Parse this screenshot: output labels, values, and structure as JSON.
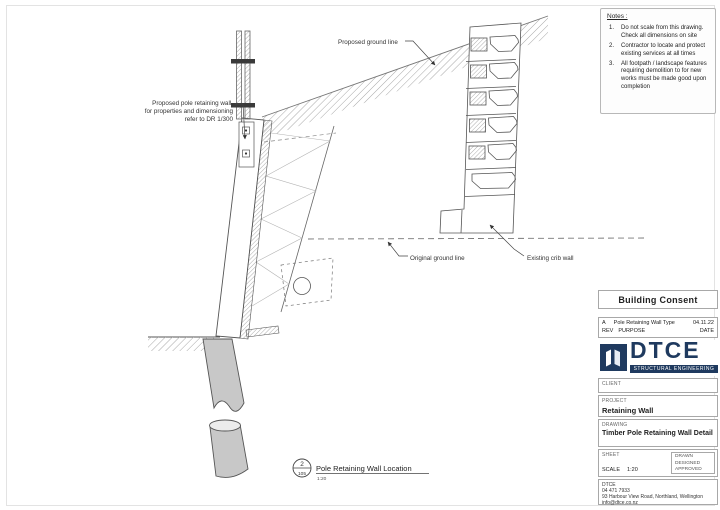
{
  "notes": {
    "title": "Notes :",
    "items": [
      {
        "num": "1.",
        "text": "Do not scale from this drawing. Check all dimensions on site"
      },
      {
        "num": "2.",
        "text": "Contractor to locate and protect existing services at all times"
      },
      {
        "num": "3.",
        "text": "All footpath / landscape features requiring demolition to for new works must be made good upon completion"
      }
    ]
  },
  "labels": {
    "proposed_ground_line": "Proposed ground line",
    "proposed_wall": {
      "line1": "Proposed pole retaining wall,",
      "line2": "for properties and dimensioning",
      "line3": "refer to DR 1/300"
    },
    "original_ground_line": "Original ground line",
    "existing_crib_wall": "Existing crib wall"
  },
  "callout": {
    "number": "2",
    "sheet": "105",
    "title": "Pole Retaining Wall Location",
    "scale": "1:20"
  },
  "title_block": {
    "consent": "Building Consent",
    "revision": {
      "rev": "A",
      "purpose": "Pole Retaining Wall Type",
      "date": "04.11.22",
      "rev_label": "REV",
      "purpose_label": "PURPOSE",
      "date_label": "DATE"
    },
    "logo": {
      "name": "DTCE",
      "tagline": "STRUCTURAL ENGINEERING"
    },
    "client_label": "CLIENT",
    "project_label": "PROJECT",
    "project_value": "Retaining Wall",
    "drawing_label": "DRAWING",
    "drawing_value": "Timber Pole Retaining Wall Detail",
    "sheet_label": "SHEET",
    "scale_label": "SCALE",
    "scale_value": "1:20",
    "drawn_label": "DRAWN",
    "designed_label": "DESIGNED",
    "approved_label": "APPROVED",
    "firm": {
      "name": "DTCE",
      "phone": "04 471 7933",
      "address": "93 Harbour View Road, Northland, Wellington",
      "email": "info@dtce.co.nz"
    }
  },
  "colors": {
    "brand_navy": "#1f3a5f",
    "line": "#555555",
    "hatch": "#9a9a9a",
    "pole_fill": "#c8c8c8"
  }
}
